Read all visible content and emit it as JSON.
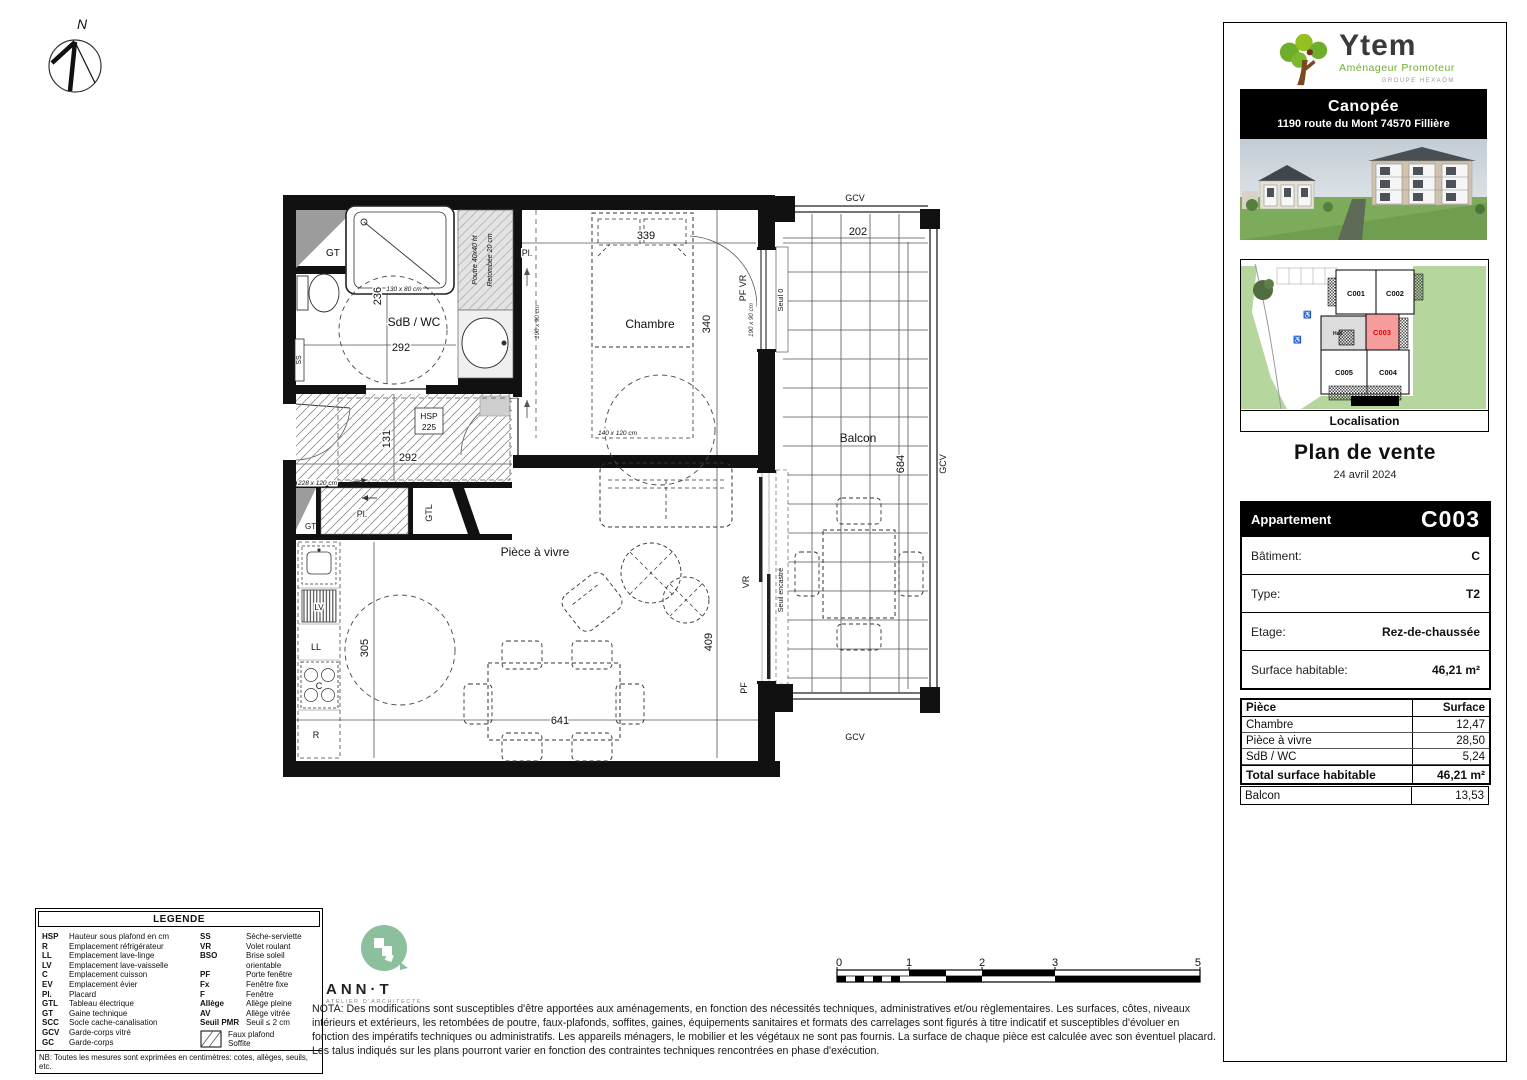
{
  "colors": {
    "ytem_green": "#76b82a",
    "ytem_green_light": "#94c11f",
    "map_green": "#b5d79e",
    "unit_highlight_fill": "#f59d9d",
    "unit_highlight_text": "#e30613",
    "annt_green": "#8cc09c",
    "banner_bg": "#000000"
  },
  "compass": {
    "north": "N"
  },
  "plan": {
    "rooms": {
      "sdb": "SdB / WC",
      "chambre": "Chambre",
      "living": "Pièce à vivre",
      "balcon": "Balcon"
    },
    "dims": {
      "sdb_height": "236",
      "sdb_width": "292",
      "hall_height": "131",
      "hall_width": "292",
      "chambre_width": "339",
      "chambre_height": "340",
      "balcon_width": "202",
      "balcon_height": "684",
      "kitchen_height": "305",
      "living_width": "641",
      "living_height": "409"
    },
    "labels": {
      "gt_top": "GT",
      "gt_bottom": "GT",
      "gtl": "GTL",
      "pl_hall": "Pl.",
      "pl_chambre": "Pl.",
      "hsp_abbr": "HSP",
      "hsp_value": "225",
      "ss": "SS",
      "lv": "LV",
      "ll": "LL",
      "cuisson": "C",
      "refrigerateur": "R",
      "poutre_1": "Poutre 40x40 ht",
      "poutre_2": "Retombée 20 cm",
      "shower_size": "130 x 80 cm",
      "bed_size_left": "190 x 90 cm",
      "bed_size_right": "190 x 90 cm",
      "turn_size": "140 x 120 cm",
      "hall_size": "228 x 120 cm",
      "pf_vr": "PF  VR",
      "seuil_zero": "Seuil 0",
      "seuil_encastre": "Seuil encastré",
      "vr": "VR",
      "pf": "PF",
      "gcv_top": "GCV",
      "gcv_right": "GCV",
      "gcv_bottom": "GCV"
    }
  },
  "sidebar": {
    "brand": {
      "name": "Ytem",
      "tagline": "Aménageur Promoteur",
      "group": "GROUPE HEXAÖM"
    },
    "project": {
      "name": "Canopée",
      "address": "1190 route du Mont 74570 Fillière"
    },
    "map": {
      "units": [
        "C001",
        "C002",
        "C003",
        "C004",
        "C005"
      ],
      "hall": "Hall",
      "caption": "Localisation"
    },
    "title": "Plan de vente",
    "date": "24 avril 2024",
    "apartment": {
      "header_label": "Appartement",
      "header_value": "C003",
      "rows": [
        {
          "label": "Bâtiment:",
          "value": "C"
        },
        {
          "label": "Type:",
          "value": "T2"
        },
        {
          "label": "Etage:",
          "value": "Rez-de-chaussée"
        },
        {
          "label": "Surface habitable:",
          "value": "46,21 m²"
        }
      ]
    },
    "surfaces": {
      "col_piece": "Pièce",
      "col_surface": "Surface",
      "rows": [
        {
          "label": "Chambre",
          "value": "12,47"
        },
        {
          "label": "Pièce à vivre",
          "value": "28,50"
        },
        {
          "label": "SdB / WC",
          "value": "5,24"
        }
      ],
      "total_label": "Total surface habitable",
      "total_value": "46,21 m²",
      "balcon_label": "Balcon",
      "balcon_value": "13,53"
    }
  },
  "legend": {
    "title": "LEGENDE",
    "left": [
      {
        "abbr": "HSP",
        "desc": "Hauteur sous plafond en cm"
      },
      {
        "abbr": "R",
        "desc": "Emplacement réfrigérateur"
      },
      {
        "abbr": "LL",
        "desc": "Emplacement lave-linge"
      },
      {
        "abbr": "LV",
        "desc": "Emplacement lave-vaisselle"
      },
      {
        "abbr": "C",
        "desc": "Emplacement cuisson"
      },
      {
        "abbr": "EV",
        "desc": "Emplacement évier"
      },
      {
        "abbr": "Pl.",
        "desc": "Placard"
      },
      {
        "abbr": "GTL",
        "desc": "Tableau électrique"
      },
      {
        "abbr": "GT",
        "desc": "Gaine technique"
      },
      {
        "abbr": "SCC",
        "desc": "Socle cache-canalisation"
      },
      {
        "abbr": "GCV",
        "desc": "Garde-corps vitré"
      },
      {
        "abbr": "GC",
        "desc": "Garde-corps"
      }
    ],
    "right": [
      {
        "abbr": "SS",
        "desc": "Sèche-serviette"
      },
      {
        "abbr": "VR",
        "desc": "Volet roulant"
      },
      {
        "abbr": "BSO",
        "desc": "Brise soleil orientable"
      },
      {
        "abbr": "PF",
        "desc": "Porte fenêtre"
      },
      {
        "abbr": "Fx",
        "desc": "Fenêtre fixe"
      },
      {
        "abbr": "F",
        "desc": "Fenêtre"
      },
      {
        "abbr": "Allège",
        "desc": "Allège pleine"
      },
      {
        "abbr": "AV",
        "desc": "Allège vitrée"
      },
      {
        "abbr": "Seuil PMR",
        "desc": "Seuil ≤ 2 cm"
      }
    ],
    "hatch_line1": "Faux plafond",
    "hatch_line2": "Soffite",
    "nb": "NB: Toutes les mesures sont exprimées en centimètres: cotes, allèges, seuils, etc."
  },
  "architect": {
    "name": "ANN·T",
    "subtitle": "ATELIER D'ARCHITECTE"
  },
  "nota": "NOTA: Des modifications sont susceptibles d'être apportées aux aménagements, en fonction des nécessités techniques, administratives et/ou règlementaires. Les surfaces, côtes, niveaux intérieurs et extérieurs, les retombées de poutre, faux-plafonds, soffites, gaines, équipements sanitaires et formats des carrelages sont figurés à titre indicatif et susceptibles d'évoluer en fonction des impératifs techniques ou administratifs. Les appareils ménagers, le mobilier et les végétaux ne sont pas fournis. La surface de chaque pièce est calculée avec son éventuel placard. Les talus indiqués sur les plans pourront varier en fonction des contraintes techniques rencontrées en phase d'exécution.",
  "scalebar": {
    "n0": "0",
    "n1": "1",
    "n2": "2",
    "n3": "3",
    "n5": "5"
  }
}
